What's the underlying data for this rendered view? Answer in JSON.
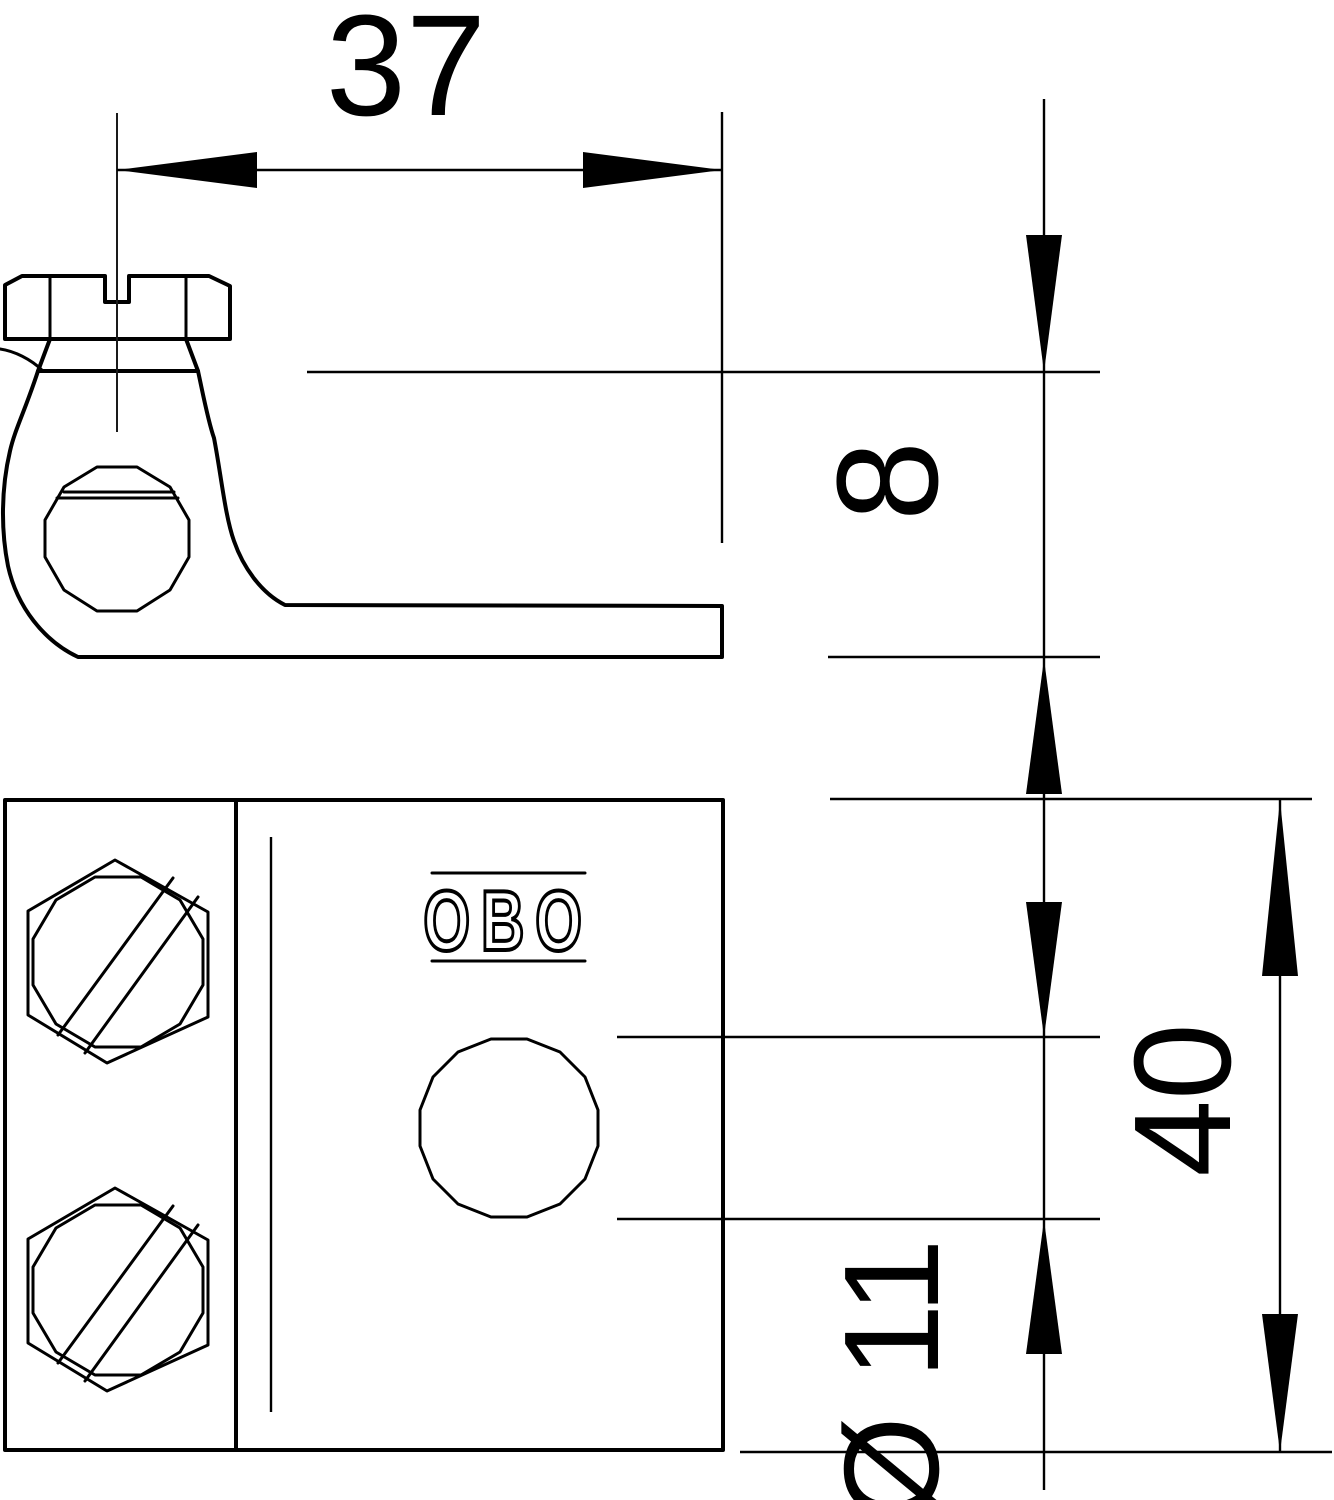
{
  "drawing": {
    "kind": "technical dimension drawing",
    "background_color": "#ffffff",
    "line_color": "#000000",
    "views": {
      "side_view": {
        "description": "clamp with slotted cheese-head screw, ring boss and flat tongue",
        "features": [
          "slotted-screw-head",
          "washer-neck",
          "ring-boss",
          "through-hole",
          "flat-tongue",
          "center-line"
        ]
      },
      "front_view": {
        "description": "rectangular clamp body with two slotted hex screws, brand stamp and cable hole",
        "features": [
          "hex-screw-upper",
          "hex-screw-lower",
          "section-divider",
          "fold-edge",
          "cable-hole",
          "brand-stamp"
        ]
      }
    },
    "logo": {
      "text": "OBO"
    },
    "dimensions": {
      "width_top": {
        "label": "37",
        "orientation": "horizontal"
      },
      "clamp_height": {
        "label": "8",
        "orientation": "vertical"
      },
      "body_height": {
        "label": "40",
        "orientation": "vertical"
      },
      "hole_diameter": {
        "label": "Ø 11",
        "orientation": "vertical"
      }
    }
  }
}
